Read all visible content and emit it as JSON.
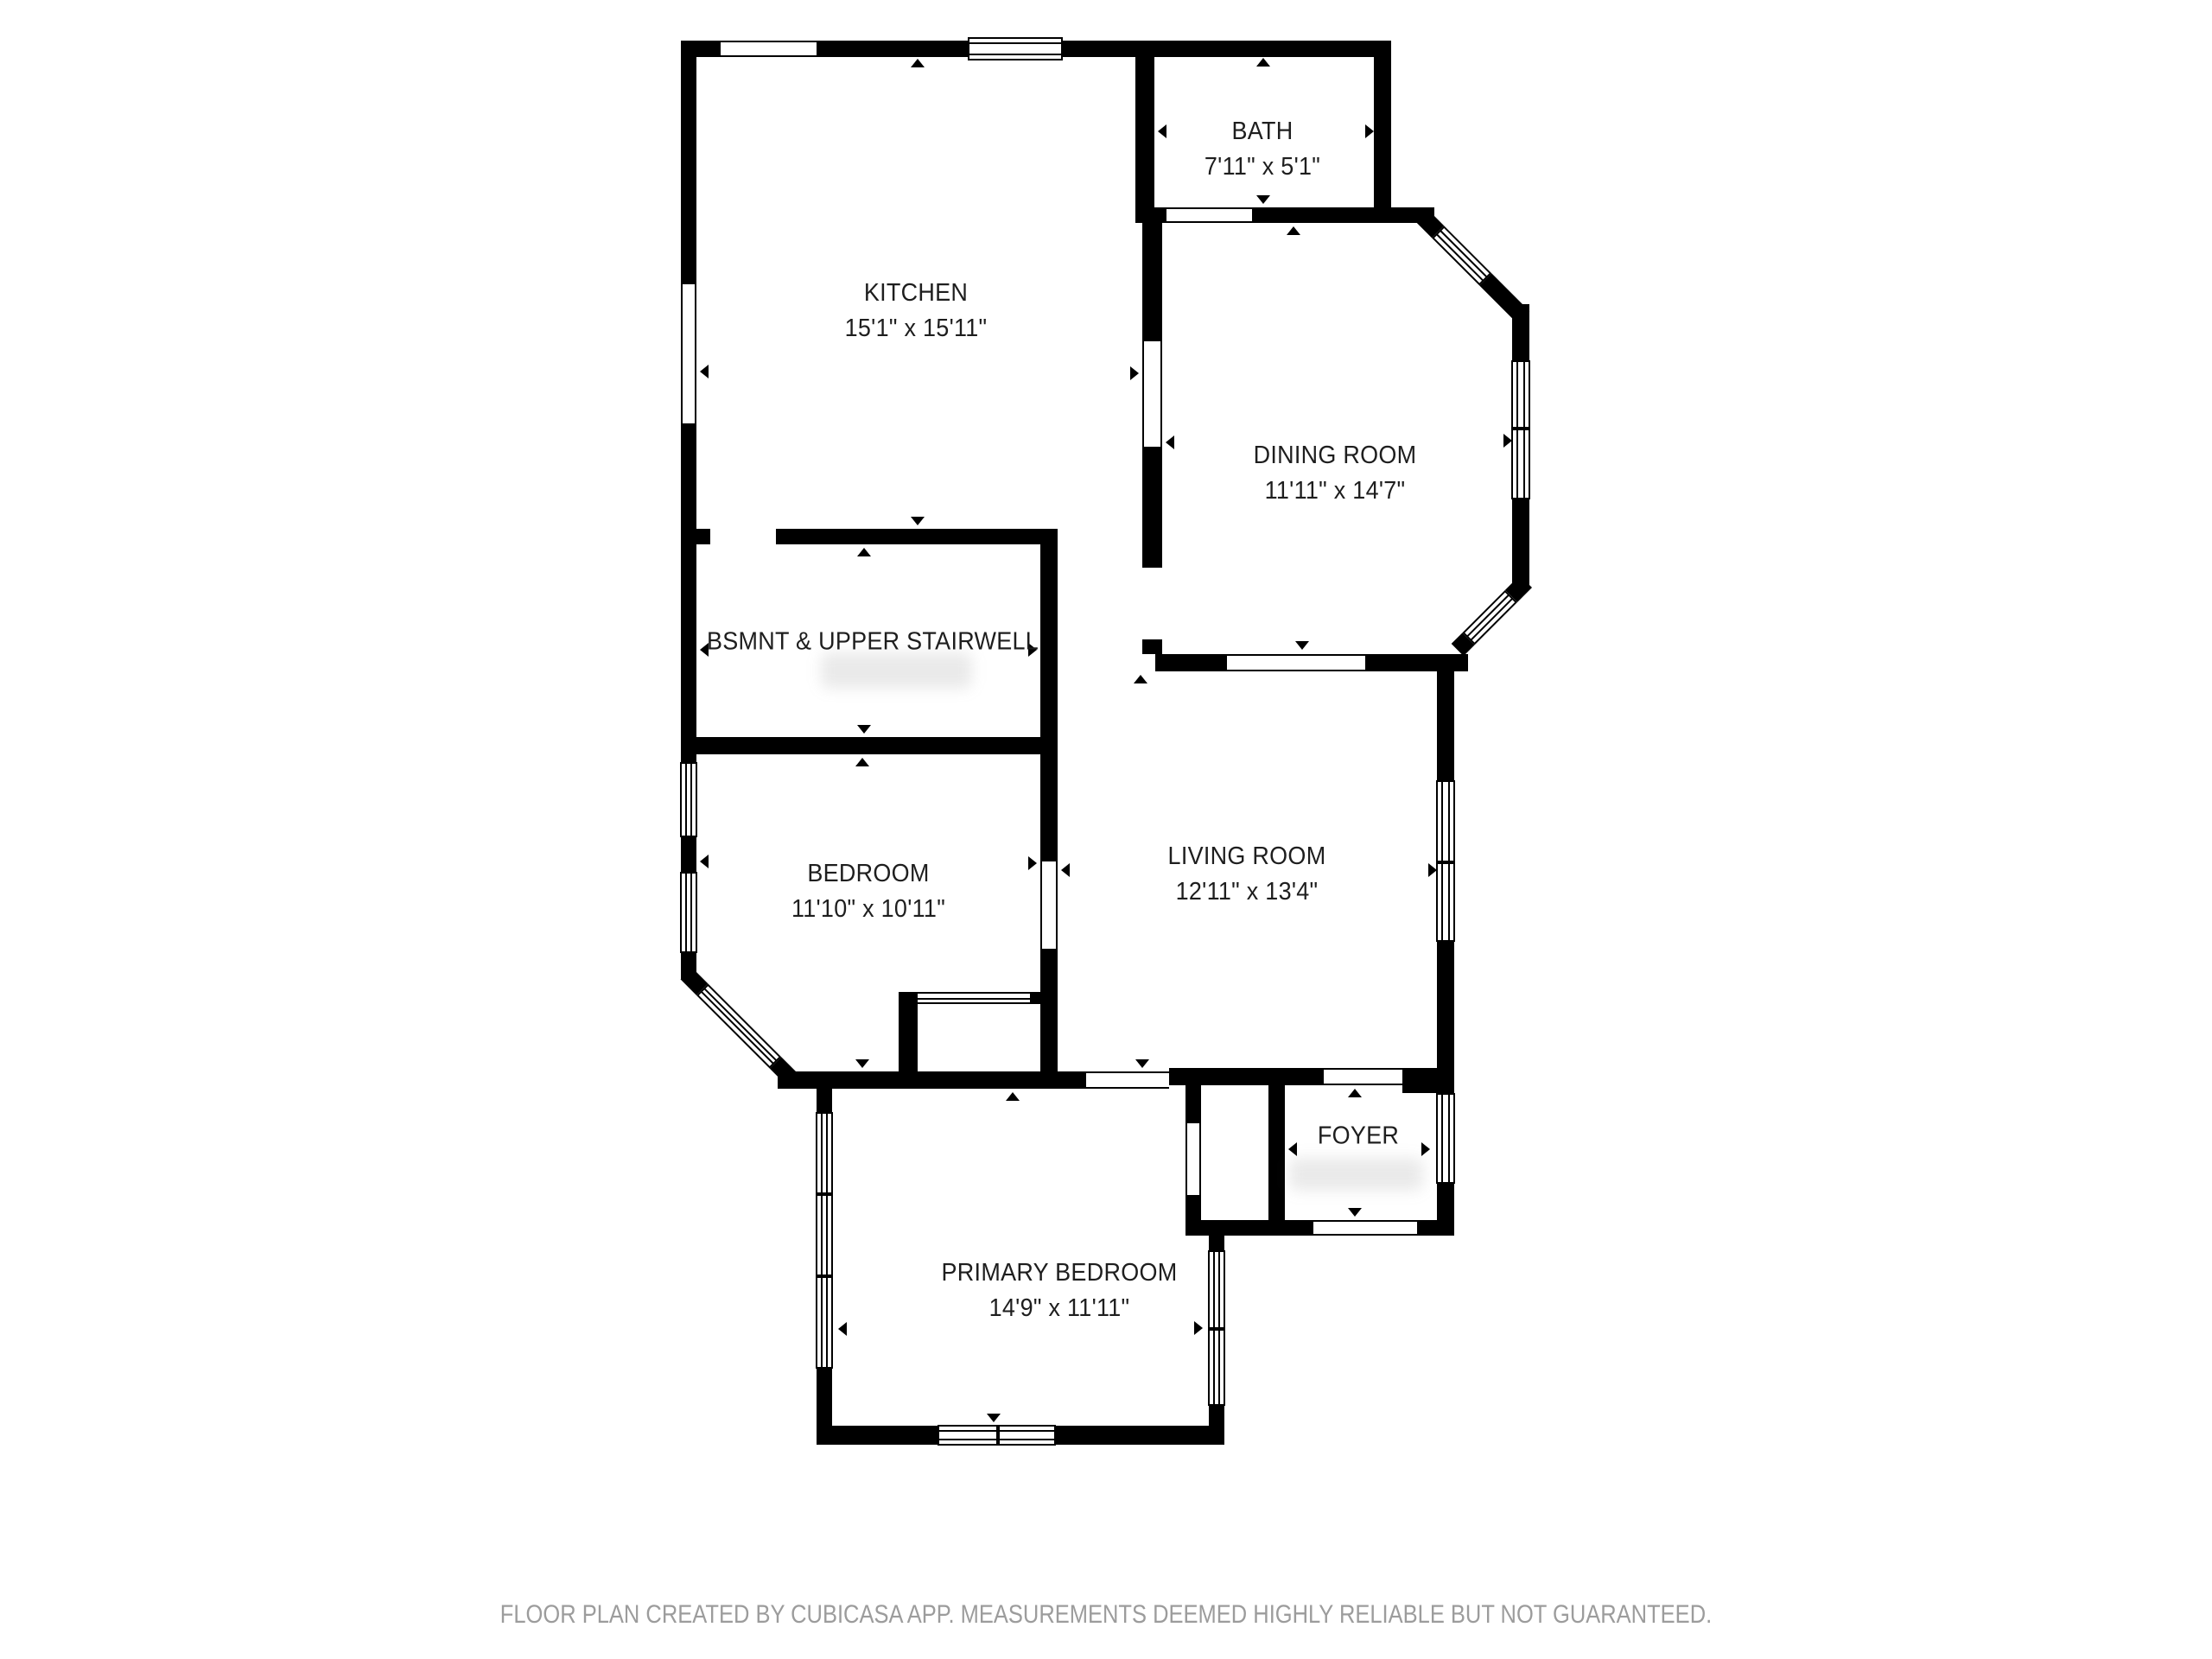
{
  "floor_plan": {
    "rooms": [
      {
        "id": "bath",
        "name": "BATH",
        "dims": "7'11\" x 5'1\""
      },
      {
        "id": "kitchen",
        "name": "KITCHEN",
        "dims": "15'1\" x 15'11\""
      },
      {
        "id": "dining",
        "name": "DINING ROOM",
        "dims": "11'11\" x 14'7\""
      },
      {
        "id": "stairwell",
        "name": "BSMNT & UPPER STAIRWELL",
        "dims": ""
      },
      {
        "id": "bedroom",
        "name": "BEDROOM",
        "dims": "11'10\" x 10'11\""
      },
      {
        "id": "living",
        "name": "LIVING ROOM",
        "dims": "12'11\" x 13'4\""
      },
      {
        "id": "foyer",
        "name": "FOYER",
        "dims": ""
      },
      {
        "id": "primary",
        "name": "PRIMARY BEDROOM",
        "dims": "14'9\" x 11'11\""
      }
    ],
    "footer": "FLOOR PLAN CREATED BY CUBICASA APP. MEASUREMENTS DEEMED HIGHLY RELIABLE BUT NOT GUARANTEED.",
    "colors": {
      "wall": "#000000",
      "label": "#1e1e1e",
      "footer": "#9c9c9c",
      "background": "#ffffff"
    }
  }
}
